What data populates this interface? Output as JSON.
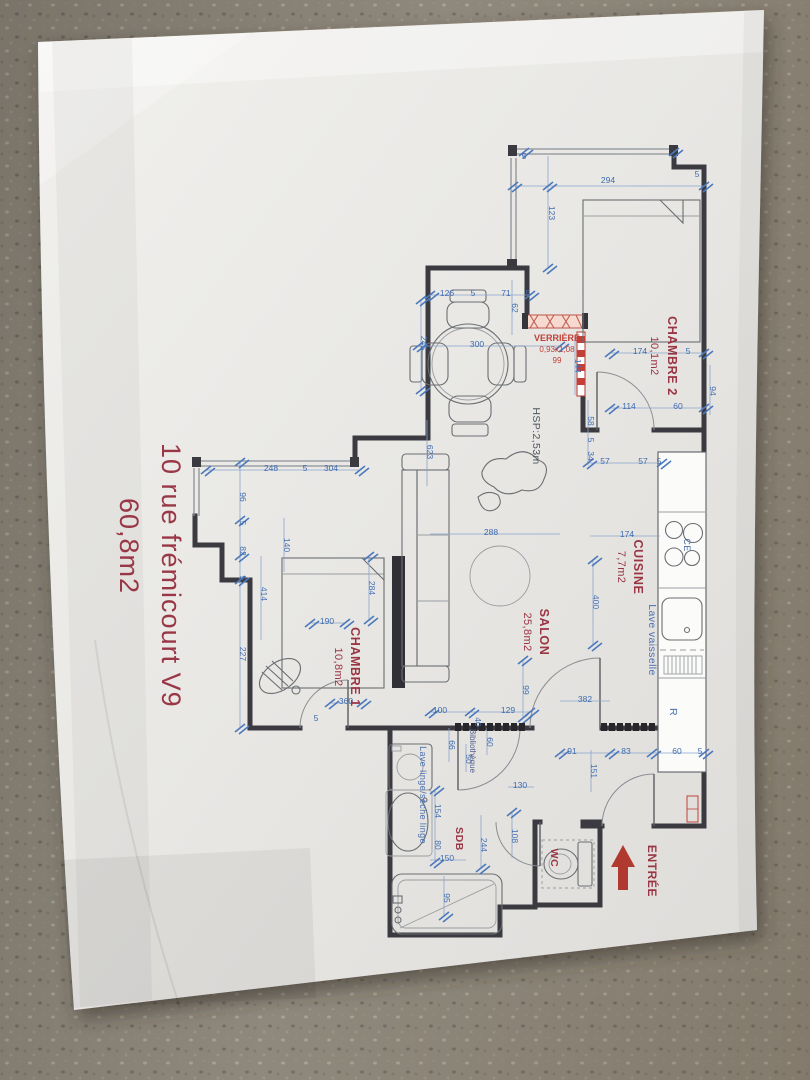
{
  "photo": {
    "carpet_color": "#898377",
    "paper_color": "#ecebe8"
  },
  "title": {
    "line1": "10 rue frémicourt V9",
    "line2": "60,8m2",
    "color": "#993746"
  },
  "rooms": {
    "chambre2": {
      "name": "CHAMBRE 2",
      "area": "10,1m2"
    },
    "cuisine": {
      "name": "CUISINE",
      "area": "7,7m2"
    },
    "salon": {
      "name": "SALON",
      "area": "25,8m2"
    },
    "chambre1": {
      "name": "CHAMBRE 1",
      "area": "10,8m2"
    },
    "sdb": {
      "name": "SDB"
    },
    "wc": {
      "name": "WC"
    }
  },
  "labels": {
    "entree": "ENTRÉE",
    "hsp": "HSP:2,53m",
    "verriere": {
      "name": "VERRIÈRE",
      "size": "0,93x1,08",
      "width": "99"
    },
    "lave_vaisselle": "Lave vaisselle",
    "lave_linge": "Lave linge/sèche linge",
    "bibliotheque": "Bibliothèque",
    "hob": "CE",
    "fridge": "R"
  },
  "dims": [
    {
      "t": "5",
      "x": 524,
      "y": 159,
      "o": "h"
    },
    {
      "t": "294",
      "x": 608,
      "y": 183,
      "o": "h"
    },
    {
      "t": "5",
      "x": 697,
      "y": 177,
      "o": "h"
    },
    {
      "t": "123",
      "x": 549,
      "y": 213,
      "o": "v"
    },
    {
      "t": "174",
      "x": 640,
      "y": 354,
      "o": "h"
    },
    {
      "t": "5",
      "x": 688,
      "y": 354,
      "o": "h"
    },
    {
      "t": "114",
      "x": 629,
      "y": 409,
      "o": "h"
    },
    {
      "t": "60",
      "x": 678,
      "y": 409,
      "o": "h"
    },
    {
      "t": "94",
      "x": 710,
      "y": 391,
      "o": "v"
    },
    {
      "t": "126",
      "x": 447,
      "y": 296,
      "o": "h"
    },
    {
      "t": "5",
      "x": 473,
      "y": 296,
      "o": "h"
    },
    {
      "t": "71",
      "x": 506,
      "y": 296,
      "o": "h"
    },
    {
      "t": "5",
      "x": 528,
      "y": 296,
      "o": "h"
    },
    {
      "t": "62",
      "x": 512,
      "y": 308,
      "o": "v"
    },
    {
      "t": "300",
      "x": 477,
      "y": 347,
      "o": "h"
    },
    {
      "t": "245",
      "x": 421,
      "y": 343,
      "o": "v"
    },
    {
      "t": "144",
      "x": 575,
      "y": 366,
      "o": "v"
    },
    {
      "t": "58",
      "x": 588,
      "y": 421,
      "o": "v"
    },
    {
      "t": "5",
      "x": 588,
      "y": 440,
      "o": "v"
    },
    {
      "t": "34",
      "x": 588,
      "y": 456,
      "o": "v"
    },
    {
      "t": "623",
      "x": 427,
      "y": 452,
      "o": "v"
    },
    {
      "t": "248",
      "x": 271,
      "y": 471,
      "o": "h"
    },
    {
      "t": "5",
      "x": 305,
      "y": 471,
      "o": "h"
    },
    {
      "t": "304",
      "x": 331,
      "y": 471,
      "o": "h"
    },
    {
      "t": "96",
      "x": 240,
      "y": 497,
      "o": "v"
    },
    {
      "t": "5",
      "x": 240,
      "y": 523,
      "o": "v"
    },
    {
      "t": "82",
      "x": 240,
      "y": 551,
      "o": "v"
    },
    {
      "t": "5",
      "x": 240,
      "y": 578,
      "o": "v"
    },
    {
      "t": "227",
      "x": 240,
      "y": 654,
      "o": "v"
    },
    {
      "t": "414",
      "x": 261,
      "y": 594,
      "o": "v"
    },
    {
      "t": "140",
      "x": 284,
      "y": 545,
      "o": "v"
    },
    {
      "t": "284",
      "x": 369,
      "y": 588,
      "o": "v"
    },
    {
      "t": "288",
      "x": 491,
      "y": 535,
      "o": "h"
    },
    {
      "t": "57",
      "x": 605,
      "y": 464,
      "o": "h"
    },
    {
      "t": "57",
      "x": 643,
      "y": 464,
      "o": "h"
    },
    {
      "t": "5",
      "x": 659,
      "y": 464,
      "o": "h"
    },
    {
      "t": "174",
      "x": 627,
      "y": 537,
      "o": "h"
    },
    {
      "t": "400",
      "x": 593,
      "y": 602,
      "o": "v"
    },
    {
      "t": "190",
      "x": 327,
      "y": 624,
      "o": "h"
    },
    {
      "t": "360",
      "x": 346,
      "y": 704,
      "o": "h"
    },
    {
      "t": "100",
      "x": 440,
      "y": 713,
      "o": "h"
    },
    {
      "t": "129",
      "x": 508,
      "y": 713,
      "o": "h"
    },
    {
      "t": "99",
      "x": 523,
      "y": 690,
      "o": "v"
    },
    {
      "t": "382",
      "x": 585,
      "y": 702,
      "o": "h"
    },
    {
      "t": "91",
      "x": 572,
      "y": 754,
      "o": "h"
    },
    {
      "t": "83",
      "x": 626,
      "y": 754,
      "o": "h"
    },
    {
      "t": "60",
      "x": 677,
      "y": 754,
      "o": "h"
    },
    {
      "t": "5",
      "x": 700,
      "y": 754,
      "o": "h"
    },
    {
      "t": "151",
      "x": 591,
      "y": 771,
      "o": "v"
    },
    {
      "t": "66",
      "x": 449,
      "y": 745,
      "o": "v"
    },
    {
      "t": "40",
      "x": 475,
      "y": 722,
      "o": "v"
    },
    {
      "t": "60",
      "x": 487,
      "y": 742,
      "o": "v"
    },
    {
      "t": "50",
      "x": 466,
      "y": 759,
      "o": "v"
    },
    {
      "t": "154",
      "x": 435,
      "y": 811,
      "o": "v"
    },
    {
      "t": "80",
      "x": 435,
      "y": 845,
      "o": "v"
    },
    {
      "t": "244",
      "x": 481,
      "y": 845,
      "o": "v"
    },
    {
      "t": "108",
      "x": 512,
      "y": 836,
      "o": "v"
    },
    {
      "t": "130",
      "x": 520,
      "y": 788,
      "o": "h"
    },
    {
      "t": "95",
      "x": 444,
      "y": 898,
      "o": "v"
    },
    {
      "t": "150",
      "x": 447,
      "y": 861,
      "o": "h"
    },
    {
      "t": "5",
      "x": 316,
      "y": 721,
      "o": "h"
    }
  ]
}
